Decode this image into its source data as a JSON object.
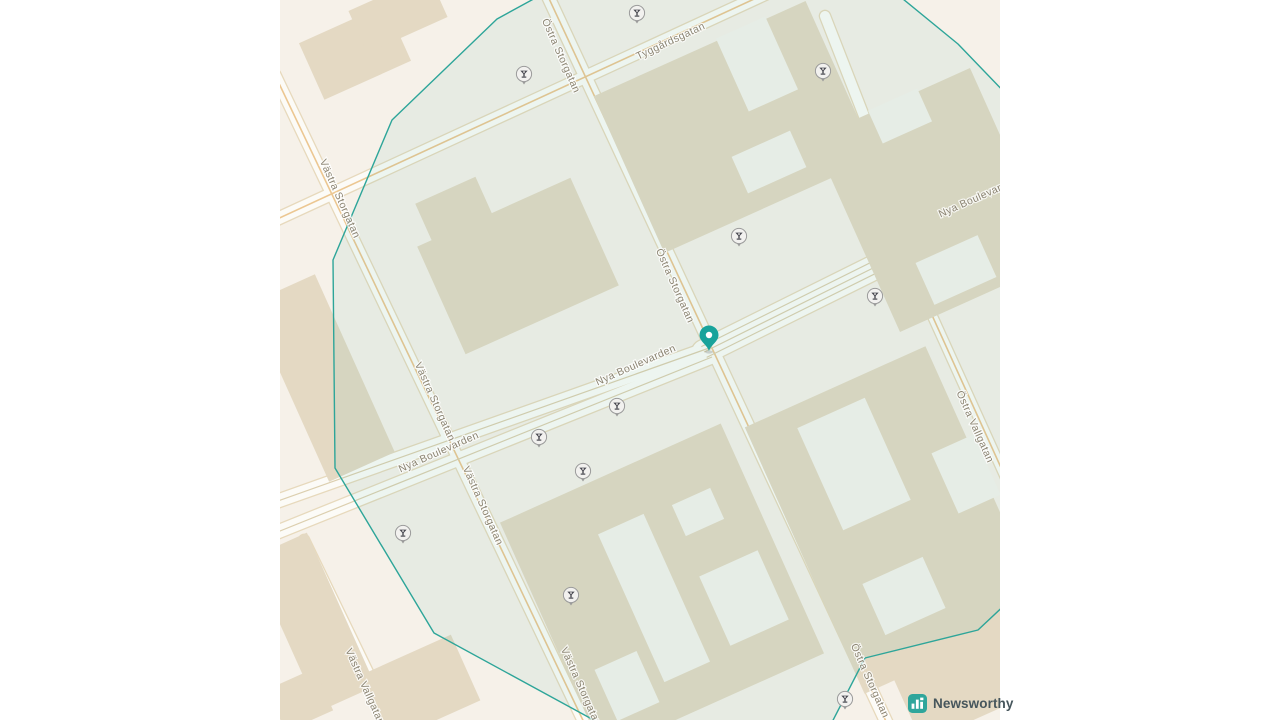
{
  "attribution": {
    "brand": "Newsworthy"
  },
  "map": {
    "street_labels": [
      {
        "text": "Östra Storgatan",
        "x": 278,
        "y": 57,
        "rot": 66
      },
      {
        "text": "Tyggårdsgatan",
        "x": 392,
        "y": 44,
        "rot": -25
      },
      {
        "text": "Västra Storgatan",
        "x": 57,
        "y": 200,
        "rot": 66
      },
      {
        "text": "Nya Boulevarden",
        "x": 700,
        "y": 200,
        "rot": -24
      },
      {
        "text": "Östra Storgatan",
        "x": 392,
        "y": 287,
        "rot": 66
      },
      {
        "text": "Nya Boulevarden",
        "x": 357,
        "y": 368,
        "rot": -24
      },
      {
        "text": "Västra Storgatan",
        "x": 152,
        "y": 403,
        "rot": 66
      },
      {
        "text": "Nya Boulevarden",
        "x": 160,
        "y": 455,
        "rot": -24
      },
      {
        "text": "Västra Storgatan",
        "x": 200,
        "y": 507,
        "rot": 66
      },
      {
        "text": "Östra Vallgatan",
        "x": 692,
        "y": 428,
        "rot": 66
      },
      {
        "text": "Västra Vallgatan",
        "x": 82,
        "y": 688,
        "rot": 66
      },
      {
        "text": "Västra Storgatan",
        "x": 298,
        "y": 688,
        "rot": 66
      },
      {
        "text": "Östra Storgatan",
        "x": 587,
        "y": 682,
        "rot": 66
      }
    ],
    "poi_markers": {
      "icon": "cocktail-glass-icon",
      "positions": [
        {
          "x": 357,
          "y": 13
        },
        {
          "x": 244,
          "y": 74
        },
        {
          "x": 543,
          "y": 71
        },
        {
          "x": 459,
          "y": 236
        },
        {
          "x": 595,
          "y": 296
        },
        {
          "x": 337,
          "y": 406
        },
        {
          "x": 259,
          "y": 437
        },
        {
          "x": 303,
          "y": 471
        },
        {
          "x": 123,
          "y": 533
        },
        {
          "x": 291,
          "y": 595
        },
        {
          "x": 565,
          "y": 699
        }
      ]
    },
    "main_pin": {
      "x": 429,
      "y": 351,
      "color": "#18a39b"
    },
    "highlight_polygon": {
      "stroke": "#2da599",
      "fill": "rgba(35,160,150,0.065)",
      "points": [
        [
          270,
          -10
        ],
        [
          217,
          19
        ],
        [
          112,
          120
        ],
        [
          53,
          260
        ],
        [
          55,
          468
        ],
        [
          154,
          633
        ],
        [
          332,
          730
        ],
        [
          548,
          730
        ],
        [
          585,
          658
        ],
        [
          698,
          630
        ],
        [
          730,
          600
        ],
        [
          730,
          98
        ],
        [
          678,
          44
        ],
        [
          612,
          -10
        ]
      ]
    },
    "colors": {
      "ground": "#f6f1e9",
      "street_fill": "#fcfbf7",
      "street_casing": "#e7d9bc",
      "minor_line": "#dccfaf",
      "orange_line": "#ecc792",
      "building": "#e4d9c3",
      "courtyard": "#f5f3ec",
      "label": "#8b8472",
      "brand_teal": "#2fa69b"
    }
  }
}
